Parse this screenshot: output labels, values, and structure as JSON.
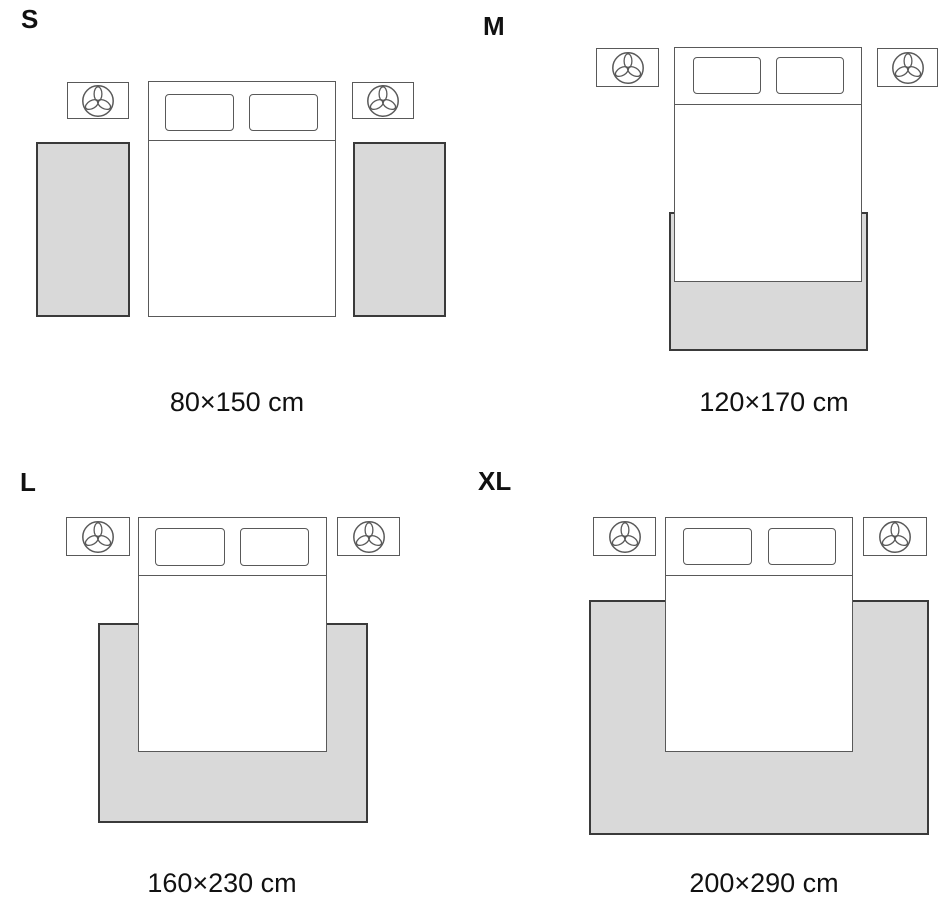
{
  "colors": {
    "background": "#ffffff",
    "furniture_line": "#595959",
    "rug_line": "#3a3a3a",
    "rug_fill": "#d9d9d9",
    "text": "#111111"
  },
  "icons": {
    "nightstand_decoration": "plant-icon"
  },
  "sizes": [
    {
      "letter": "S",
      "dimensions": "80×150 cm"
    },
    {
      "letter": "M",
      "dimensions": "120×170 cm"
    },
    {
      "letter": "L",
      "dimensions": "160×230 cm"
    },
    {
      "letter": "XL",
      "dimensions": "200×290 cm"
    }
  ]
}
